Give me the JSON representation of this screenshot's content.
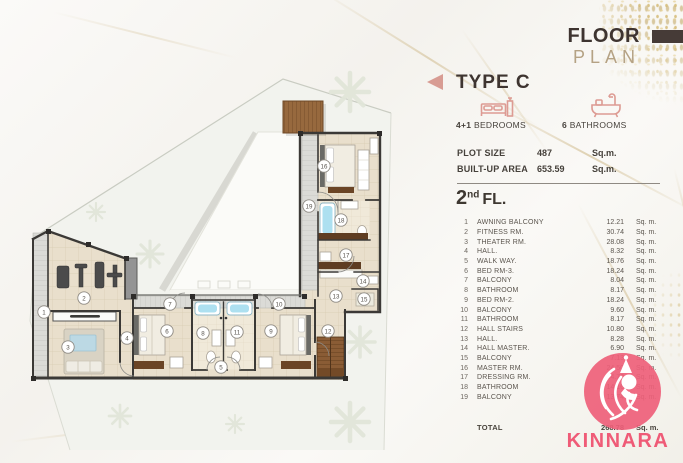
{
  "header": {
    "title_line1": "FLOOR",
    "title_line2": "PLAN"
  },
  "type": {
    "label": "TYPE C"
  },
  "features": {
    "bedrooms_value": "4+1",
    "bedrooms_label": " BEDROOMS",
    "bathrooms_value": "6",
    "bathrooms_label": " BATHROOMS"
  },
  "specs": [
    {
      "label": "PLOT SIZE",
      "value": "487",
      "unit": "Sq.m."
    },
    {
      "label": "BUILT-UP AREA",
      "value": "653.59",
      "unit": "Sq.m."
    }
  ],
  "floor": {
    "number": "2",
    "suffix": "nd",
    "label": "FL."
  },
  "rooms": [
    {
      "no": "1",
      "name": "AWNING BALCONY",
      "area": "12.21",
      "unit": "Sq. m."
    },
    {
      "no": "2",
      "name": "FITNESS RM.",
      "area": "30.74",
      "unit": "Sq. m."
    },
    {
      "no": "3",
      "name": "THEATER RM.",
      "area": "28.08",
      "unit": "Sq. m."
    },
    {
      "no": "4",
      "name": "HALL.",
      "area": "8.32",
      "unit": "Sq. m."
    },
    {
      "no": "5",
      "name": "WALK WAY.",
      "area": "18.76",
      "unit": "Sq. m."
    },
    {
      "no": "6",
      "name": "BED RM-3.",
      "area": "18.24",
      "unit": "Sq. m."
    },
    {
      "no": "7",
      "name": "BALCONY",
      "area": "8.04",
      "unit": "Sq. m."
    },
    {
      "no": "8",
      "name": "BATHROOM",
      "area": "8.17",
      "unit": "Sq. m."
    },
    {
      "no": "9",
      "name": "BED RM-2.",
      "area": "18.24",
      "unit": "Sq. m."
    },
    {
      "no": "10",
      "name": "BALCONY",
      "area": "9.60",
      "unit": "Sq. m."
    },
    {
      "no": "11",
      "name": "BATHROOM",
      "area": "8.17",
      "unit": "Sq. m."
    },
    {
      "no": "12",
      "name": "HALL STAIRS",
      "area": "10.80",
      "unit": "Sq. m."
    },
    {
      "no": "13",
      "name": "HALL.",
      "area": "8.28",
      "unit": "Sq. m."
    },
    {
      "no": "14",
      "name": "HALL MASTER.",
      "area": "6.90",
      "unit": "Sq. m."
    },
    {
      "no": "15",
      "name": "BALCONY",
      "area": "7.13",
      "unit": "Sq. m."
    },
    {
      "no": "16",
      "name": "MASTER RM.",
      "area": "24.50",
      "unit": "Sq. m."
    },
    {
      "no": "17",
      "name": "DRESSING RM.",
      "area": "14.70",
      "unit": "Sq. m."
    },
    {
      "no": "18",
      "name": "BATHROOM",
      "area": "14.16",
      "unit": "Sq. m."
    },
    {
      "no": "19",
      "name": "BALCONY",
      "area": "13.74",
      "unit": "Sq. m."
    }
  ],
  "total": {
    "no": "",
    "label": "TOTAL",
    "value": "268.78",
    "unit": "Sq. m."
  },
  "brand": {
    "name": "KINNARA"
  },
  "colors": {
    "accent_pink": "#ef5b77",
    "accent_rose": "#d89c93",
    "title_dark": "#3e3430",
    "title_tan": "#b5a284",
    "wall": "#3b3936",
    "floor_beige": "#e9dfcc",
    "tub_blue": "#ade0f0",
    "wood": "#8a5c35"
  },
  "plan": {
    "markers": [
      {
        "no": "1",
        "x": 44,
        "y": 312
      },
      {
        "no": "2",
        "x": 84,
        "y": 298
      },
      {
        "no": "3",
        "x": 68,
        "y": 347
      },
      {
        "no": "4",
        "x": 127,
        "y": 338
      },
      {
        "no": "5",
        "x": 221,
        "y": 367
      },
      {
        "no": "6",
        "x": 167,
        "y": 331
      },
      {
        "no": "7",
        "x": 170,
        "y": 304
      },
      {
        "no": "8",
        "x": 203,
        "y": 333
      },
      {
        "no": "9",
        "x": 271,
        "y": 331
      },
      {
        "no": "10",
        "x": 279,
        "y": 304
      },
      {
        "no": "11",
        "x": 237,
        "y": 332
      },
      {
        "no": "12",
        "x": 328,
        "y": 331
      },
      {
        "no": "13",
        "x": 336,
        "y": 296
      },
      {
        "no": "14",
        "x": 363,
        "y": 281
      },
      {
        "no": "15",
        "x": 364,
        "y": 299
      },
      {
        "no": "16",
        "x": 324,
        "y": 166
      },
      {
        "no": "17",
        "x": 346,
        "y": 255
      },
      {
        "no": "18",
        "x": 341,
        "y": 220
      },
      {
        "no": "19",
        "x": 309,
        "y": 206
      }
    ]
  }
}
